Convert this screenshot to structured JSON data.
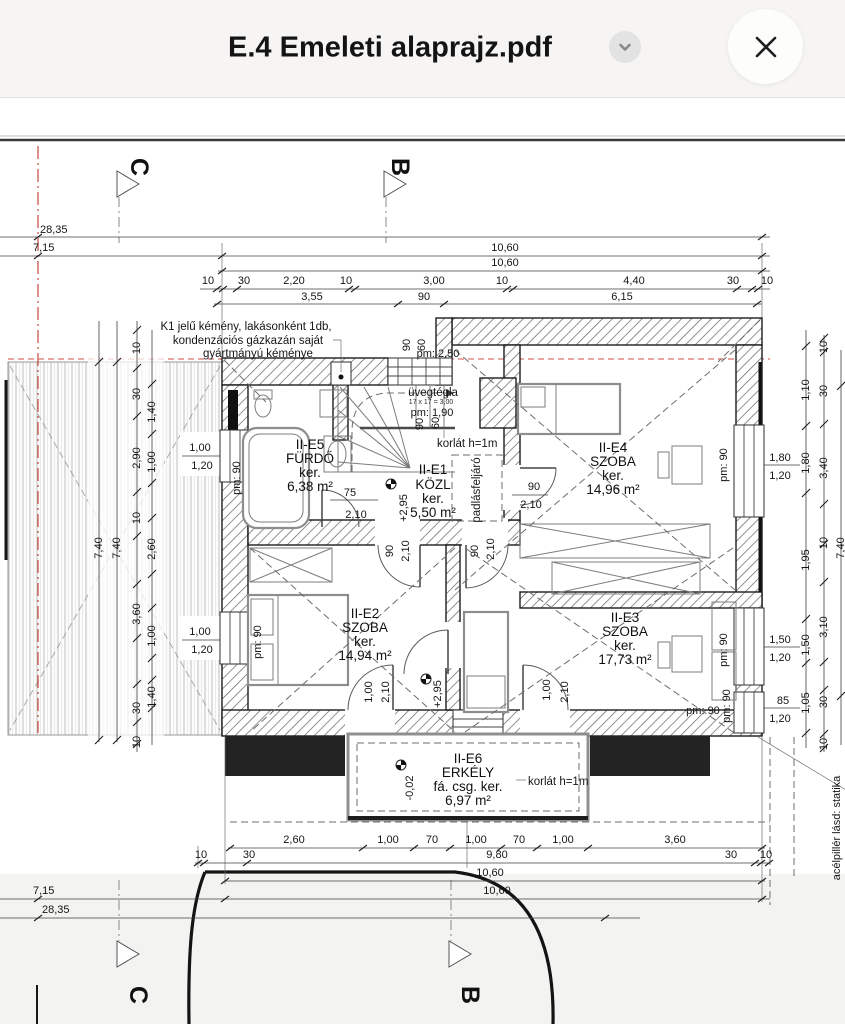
{
  "header": {
    "title": "E.4 Emeleti alaprajz.pdf"
  },
  "markers": {
    "c": "C",
    "b": "B"
  },
  "rooms": {
    "e5": {
      "id": "II-E5",
      "n": "FÜRDŐ",
      "k": "ker.",
      "a": "6,38 m²"
    },
    "e1": {
      "id": "II-E1",
      "n": "KÖZL",
      "k": "ker.",
      "a": "5,50 m²"
    },
    "e4": {
      "id": "II-E4",
      "n": "SZOBA",
      "k": "ker.",
      "a": "14,96 m²"
    },
    "e2": {
      "id": "II-E2",
      "n": "SZOBA",
      "k": "ker.",
      "a": "14,94 m²"
    },
    "e3": {
      "id": "II-E3",
      "n": "SZOBA",
      "k": "ker.",
      "a": "17,73 m²"
    },
    "e6": {
      "id": "II-E6",
      "n": "ERKÉLY",
      "k": "fá. csg. ker.",
      "a": "6,97 m²"
    }
  },
  "notes": {
    "chimney1": "K1 jelű kémény, lakásonként 1db,",
    "chimney2": "kondenzációs gázkazán saját",
    "chimney3": "gyártmányú kéménye",
    "glass": "üvegtégla",
    "glass_small": "17 x 17 = 3,00",
    "glass_pm": "pm: 1,90",
    "pm250": "pm: 2,50",
    "pm90": "pm: 90",
    "railing": "korlát h=1m",
    "attic": "padlásfeljáró",
    "steel": "acélpillér lásd: statika",
    "lvl_up": "+2,95",
    "lvl_dn": "-0,02"
  },
  "dims": {
    "total": "28,35",
    "t715": "7,15",
    "t1060": "10,60",
    "t740": "7,40",
    "topChain": [
      "10",
      "30",
      "2,20",
      "10",
      "3,00",
      "10",
      "4,40",
      "30",
      "10"
    ],
    "topSub": [
      "3,55",
      "90",
      "6,15"
    ],
    "botChain": [
      "2,60",
      "1,00",
      "70",
      "1,00",
      "70",
      "1,00",
      "3,60"
    ],
    "botRow": [
      "10",
      "30",
      "9,80",
      "30",
      "10"
    ],
    "leftA": [
      "10",
      "30",
      "2,90",
      "10",
      "3,60",
      "30",
      "10"
    ],
    "leftB": [
      "1,40",
      "1,00",
      "2,60",
      "1,00",
      "1,40"
    ],
    "rightI": [
      "1,10",
      "1,80",
      "1,95",
      "1,50",
      "1,05"
    ],
    "rightO": [
      "10",
      "30",
      "3,40",
      "10",
      "3,10",
      "30",
      "10"
    ],
    "win100": "1,00",
    "win120": "1,20",
    "win180": "1,80",
    "win150": "1,50",
    "win85": "85",
    "d90": "90",
    "d60": "60",
    "d210": "2,10",
    "d75": "75"
  }
}
